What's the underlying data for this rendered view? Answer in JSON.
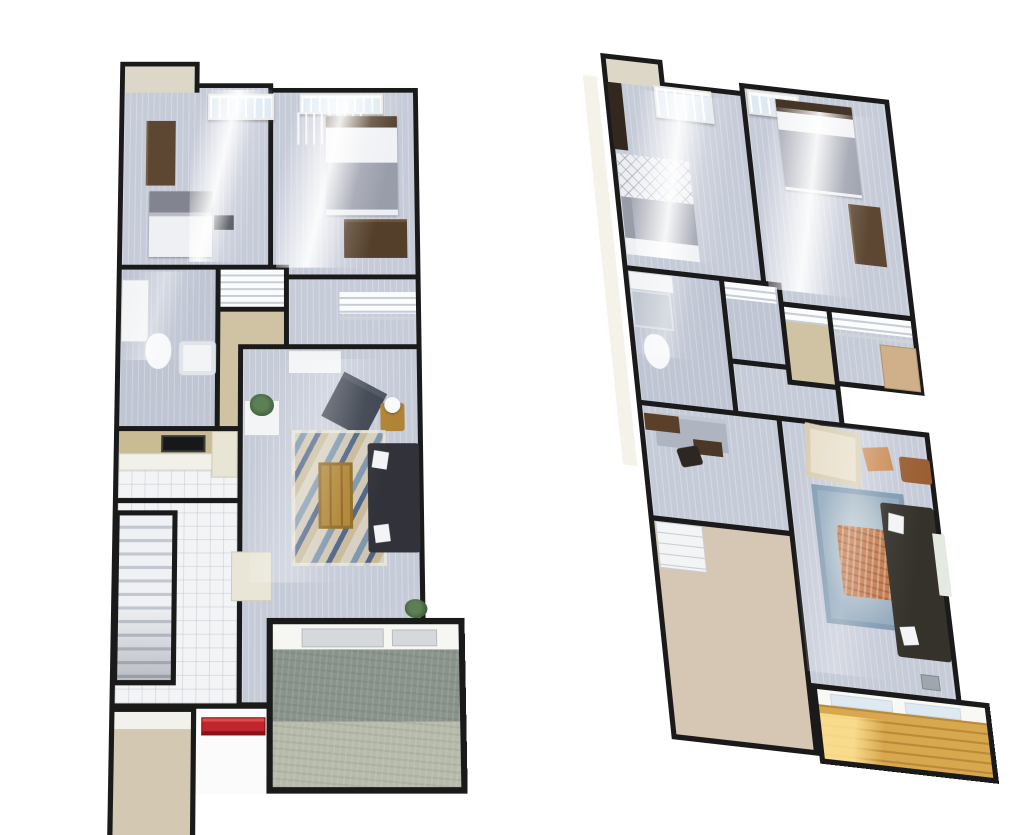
{
  "scene": {
    "background": "#ffffff",
    "kind": "pair of 3D rendered floor plans, two-level townhome, white background",
    "plan_count": 2
  },
  "palette": {
    "wall": "#1a1a1a",
    "floor-plank": "#c6cbd8",
    "floor-tile": "#f3f4f6",
    "floor-tan": "#cfc3a3",
    "floor-blush": "#d6c6b4",
    "alcove-beige": "#dcd7c6",
    "stone-dark": "#8a948c",
    "stone-light": "#b6bbab",
    "deck-wood": "#d8a84f",
    "rug-cream": "#d7d0c0",
    "rug-blue": "#7e96ac",
    "rug-navy": "#4d6388",
    "rug-right": "#90a8bc",
    "ottoman": "#c1794a",
    "sofa-dark": "#32323a",
    "chair-dark": "#3e4450",
    "cream-chair": "#e8dfca",
    "wood-mid": "#b08434",
    "wood-dark": "#543f2a",
    "dresser-brown": "#5d4733",
    "wardrobe-dark": "#32281e",
    "headboard-gray": "#82858f",
    "blanket-gray": "#999daa",
    "sheet-white": "#eef0f3",
    "red-mat": "#c1262e",
    "cabinet-tan": "#c9bc95",
    "counter-white": "#f1f1ea",
    "stove-black": "#17181a",
    "bench-gray": "#d6d9dc",
    "plant-green": "#41603c",
    "glass-blue": "#dfe9f2",
    "side-band": "#f4f2e9",
    "gray-cab": "#aeb4c0"
  },
  "plans": [
    {
      "id": "plan-left",
      "label": "left floor plan - main level, straight-on view",
      "rooms": [
        "alcove",
        "bedroom-1",
        "bedroom-2",
        "bathroom",
        "linen-closet",
        "closet",
        "hallway",
        "walk-in-closet",
        "kitchen",
        "stair-hall",
        "staircase",
        "living-room",
        "entry-walk",
        "garage",
        "patio"
      ],
      "furniture": [
        "dresser",
        "bed",
        "nightstand",
        "bed",
        "desk",
        "bath-vanity",
        "toilet",
        "bathtub",
        "closet-shelves",
        "hall-shelf",
        "kitchen-cabinets",
        "stove",
        "kitchen-counter",
        "tall-cabinet",
        "console-table",
        "potted-plant",
        "armchair",
        "side-table-with-lamp",
        "chevron-area-rug",
        "coffee-table",
        "sofa",
        "lounge-chair",
        "potted-plant",
        "red-door-mat",
        "patio-benches"
      ]
    },
    {
      "id": "plan-right",
      "label": "right floor plan - upper level, skewed perspective view",
      "rooms": [
        "alcove",
        "bedroom-1",
        "bedroom-2",
        "bathroom",
        "closet",
        "closet",
        "walk-in-closet",
        "hallway",
        "den",
        "bedroom-3",
        "living-room",
        "balcony"
      ],
      "furniture": [
        "wardrobe",
        "quilted-bed",
        "bed",
        "dresser",
        "bath-vanity",
        "shower-tile",
        "toilet",
        "closet-shelves",
        "closet-bench",
        "cabinet-desk",
        "wood-shelf",
        "office-chair",
        "drawer-chest",
        "cream-armchair",
        "accent-pillow",
        "side-table",
        "area-rug",
        "tufted-ottoman",
        "sofa",
        "throw-blanket",
        "floor-vent",
        "wood-deck-boards"
      ]
    }
  ]
}
